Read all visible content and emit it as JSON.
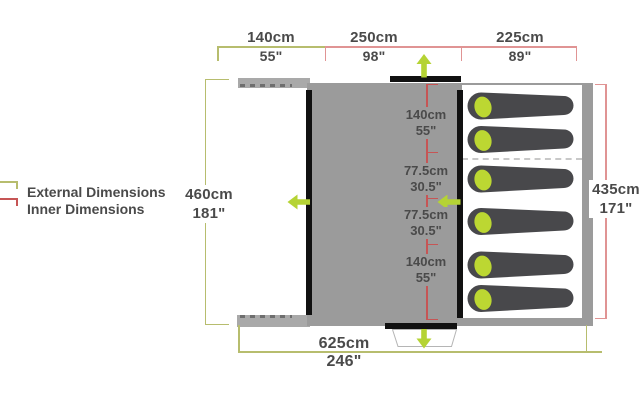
{
  "legend": {
    "external": {
      "label": "External Dimensions"
    },
    "inner": {
      "label": "Inner Dimensions"
    }
  },
  "dimensions": {
    "top": [
      {
        "cm": "140cm",
        "inch": "55\""
      },
      {
        "cm": "250cm",
        "inch": "98\""
      },
      {
        "cm": "225cm",
        "inch": "89\""
      }
    ],
    "left": {
      "cm": "460cm",
      "inch": "181\""
    },
    "right": {
      "cm": "435cm",
      "inch": "171\""
    },
    "bottom": {
      "cm": "625cm",
      "inch": "246\""
    },
    "inner_column": [
      {
        "cm": "140cm",
        "inch": "55\""
      },
      {
        "cm": "77.5cm",
        "inch": "30.5\""
      },
      {
        "cm": "77.5cm",
        "inch": "30.5\""
      },
      {
        "cm": "140cm",
        "inch": "55\""
      }
    ]
  },
  "tent": {
    "sleeping_bag_count": 6
  },
  "colors": {
    "external": "#b7bd6e",
    "inner": "#e09494",
    "inner_dark": "#c65555",
    "arrow": "#b5d334",
    "body": "#9b9b9b",
    "porch": "#a9a9a9",
    "pod": "#ffffff",
    "wall": "#111111",
    "bag": "#48484b",
    "pillow": "#bcd732",
    "text": "#4a4a4a",
    "hatch": "#6e6e6e",
    "divider": "#c8c8c8",
    "door_outline": "#b5b5b5"
  }
}
